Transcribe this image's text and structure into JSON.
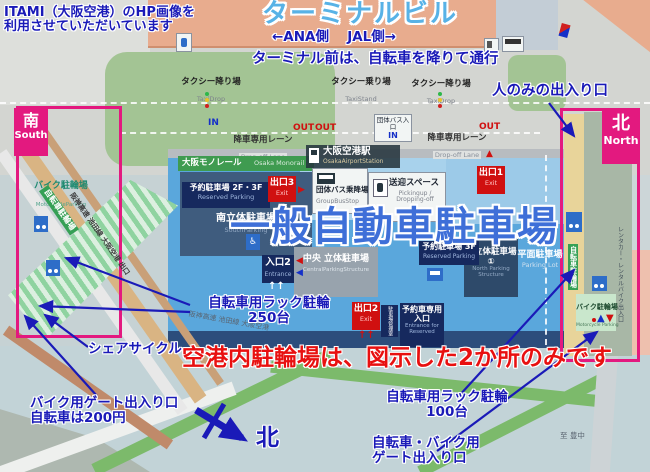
{
  "credit": {
    "line1": "ITAMI（大阪空港）のHP画像を",
    "line2": "利用させていただいています"
  },
  "titles": {
    "terminal": "ターミナルビル",
    "sides": "←ANA側　 JAL側→",
    "rule": "ターミナル前は、自転車を降りて通行",
    "main_parking": "一般自動車駐車場",
    "notice": "空港内駐輪場は、図示した2か所のみです"
  },
  "annotations": {
    "people_only": "人のみの出入り口",
    "rack250_line1": "自転車用ラック駐輪",
    "rack250_line2": "250台",
    "share_cycle": "シェアサイクル",
    "gate_left_line1": "バイク用ゲート出入り口",
    "gate_left_line2": "自転車は200円",
    "rack100_line1": "自転車用ラック駐輪",
    "rack100_line2": "100台",
    "gate_right_line1": "自転車・バイク用",
    "gate_right_line2": "ゲート出入り口",
    "compass_north": "北"
  },
  "regions": {
    "south_ja": "南",
    "south_en": "South",
    "north_ja": "北",
    "north_en": "North"
  },
  "roads": {
    "taxi_drop_ja": "タクシー降り場",
    "taxi_drop_en": "TaxiDrop",
    "taxi_stand_ja": "タクシー乗り場",
    "taxi_stand_en": "TaxiStand",
    "dropoff_ja": "降車専用レーン",
    "dropoff_en": "Drop-off Lane",
    "in": "IN",
    "out": "OUT",
    "group_bus_in": "団体バス入口",
    "expressway": "阪神高速 池田線 大阪空港 出口",
    "road_bottom": "阪神高速 池田線 大阪空港",
    "to_dest": "至 豊中"
  },
  "transit": {
    "monorail_ja": "大阪モノレール",
    "monorail_en": "Osaka Monorail",
    "station_ja": "大阪空港駅",
    "station_en": "OsakaAirportStation",
    "group_bus_ja": "団体バス乗降場",
    "group_bus_en": "GroupBusStop",
    "pickup_ja": "送迎スペース",
    "pickup_en": "Pickingup / Dropping-off"
  },
  "parking": {
    "reserved_2f3f": "予約駐車場 2F・3F",
    "reserved_3f": "予約駐車場 3F",
    "reserved_en": "Reserved Parking",
    "south_ja": "南立体駐車場",
    "south_en": "SouthParking",
    "central_ja": "中央 立体駐車場",
    "central_en": "CentralParkingStructure",
    "north_ja": "北立体駐車場①",
    "north_en": "North Parking Structure",
    "flat_ja": "平面駐車場",
    "flat_en": "Parking Lot",
    "exit1": "出口1",
    "exit2": "出口2",
    "exit3": "出口3",
    "exit_en": "Exit",
    "entrance2": "入口2",
    "entrance_en": "Entrance",
    "reserved_gate_ja": "予約車専用入口",
    "reserved_gate_en": "Entrance for Reserved",
    "office": "駐車場管理室"
  },
  "bike": {
    "moto_left_ja": "バイク駐輪場",
    "moto_left_en": "MotorcycleParking",
    "bicycle_diag": "自転車駐輪場",
    "bicycle_right": "自転車駐輪場",
    "moto_right_ja": "バイク駐輪場",
    "moto_right_en": "Motorcycle Parking",
    "rental": "レンタカー・レンタルバイク出入口"
  },
  "colors": {
    "annotation_blue": "#1a1ab8",
    "title_sky": "#58b2e6",
    "notice_red": "#e81010",
    "accent_pink": "#e3197f",
    "apron_blue": "#5aa7dc",
    "exit_red": "#d01010",
    "navy": "#16295e",
    "road_green": "#7cba6b",
    "terminal_salmon": "#e8ac8e"
  }
}
